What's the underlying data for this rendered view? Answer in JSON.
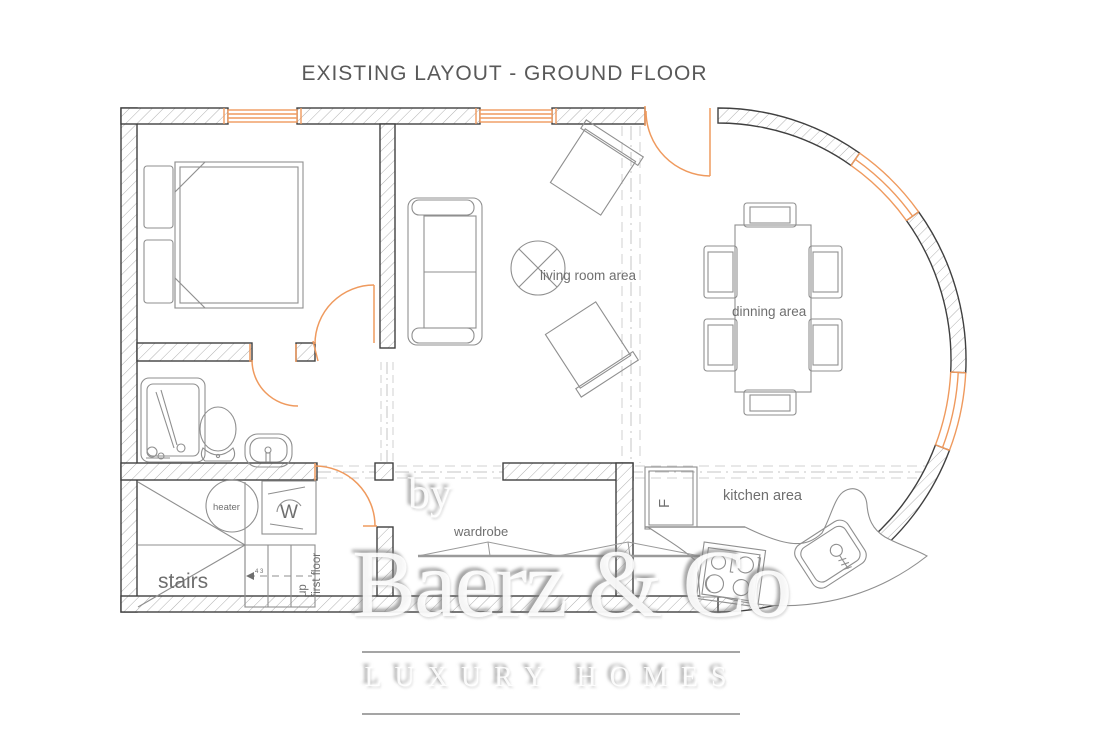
{
  "title": "EXISTING LAYOUT -  GROUND FLOOR",
  "rooms": {
    "living": "living room area",
    "dining": "dinning area",
    "kitchen": "kitchen area",
    "wardrobe": "wardrobe",
    "stairs": "stairs",
    "heater": "heater",
    "stairs_up_line1": "up",
    "stairs_up_line2": "first floor",
    "stairs_mark": "4 3"
  },
  "appliances": {
    "washing_machine_letter": "W",
    "fridge_letter": "F"
  },
  "watermark": {
    "prefix": "by",
    "brand": "Baerz & Co",
    "tagline": "LUXURY HOMES"
  },
  "colors": {
    "accent_orange": "#EF9A5E",
    "wall_outline": "#404040",
    "hatch_gray": "#b0b0b0",
    "furniture_gray": "#8f8f8f",
    "label_gray": "#6f6f6f",
    "appliance_blue": "#4646e8",
    "title_gray": "#595959"
  }
}
